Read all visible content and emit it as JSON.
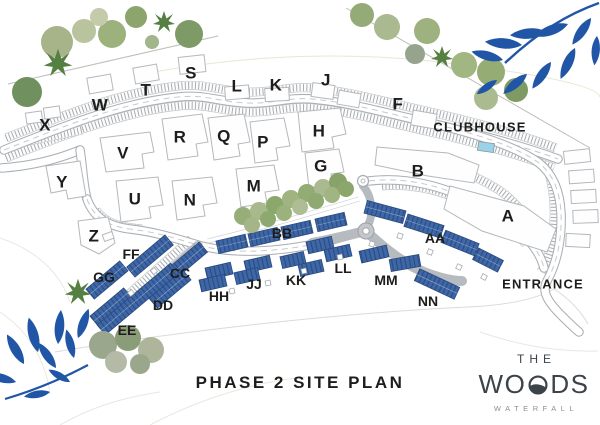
{
  "site_plan": {
    "title": "PHASE 2 SITE PLAN",
    "clubhouse": "CLUBHOUSE",
    "entrance": "ENTRANCE",
    "blocks": [
      {
        "label": "X"
      },
      {
        "label": "W"
      },
      {
        "label": "T"
      },
      {
        "label": "S"
      },
      {
        "label": "L"
      },
      {
        "label": "K"
      },
      {
        "label": "J"
      },
      {
        "label": "F"
      },
      {
        "label": "V"
      },
      {
        "label": "R"
      },
      {
        "label": "Q"
      },
      {
        "label": "P"
      },
      {
        "label": "H"
      },
      {
        "label": "G"
      },
      {
        "label": "M"
      },
      {
        "label": "N"
      },
      {
        "label": "U"
      },
      {
        "label": "Y"
      },
      {
        "label": "Z"
      },
      {
        "label": "B"
      },
      {
        "label": "A"
      },
      {
        "label": "FF"
      },
      {
        "label": "GG"
      },
      {
        "label": "CC"
      },
      {
        "label": "DD"
      },
      {
        "label": "EE"
      },
      {
        "label": "HH"
      },
      {
        "label": "JJ"
      },
      {
        "label": "KK"
      },
      {
        "label": "LL"
      },
      {
        "label": "MM"
      },
      {
        "label": "NN"
      },
      {
        "label": "BB"
      },
      {
        "label": "AA"
      }
    ]
  },
  "logo": {
    "the": "THE",
    "woods_start": "WO",
    "woods_end": "DS",
    "tagline": "WATERFALL"
  },
  "colors": {
    "phase2_blue": "#3e67a8",
    "phase2_stripe": "#2b4b80",
    "leaf_blue": "#2156a7",
    "pool_blue": "#9ad2e8",
    "text": "#1d1d1b",
    "logo_gray": "#3d434b"
  }
}
